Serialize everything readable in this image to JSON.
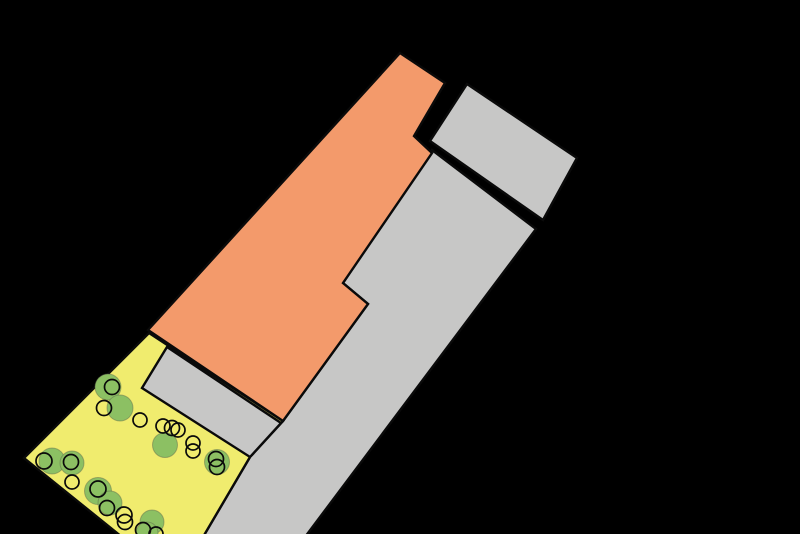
{
  "canvas": {
    "width": 800,
    "height": 534,
    "background": "#000000"
  },
  "palette": {
    "building_orange": "#F39A6B",
    "surface_gray": "#C7C7C6",
    "green_space_yellow": "#F0EC6E",
    "tree_green": "#8CC063",
    "outline_black": "#0A0A0A"
  },
  "site_plan": {
    "stroke_width_shapes": 2.4,
    "stroke_width_trees": 1.7,
    "shapes": [
      {
        "id": "road-parcel",
        "fill_key": "surface_gray",
        "points": [
          [
            432,
            150
          ],
          [
            536,
            229
          ],
          [
            305,
            537
          ],
          [
            203,
            537
          ],
          [
            250,
            457
          ],
          [
            283,
            421
          ],
          [
            368,
            304
          ],
          [
            343,
            283
          ]
        ]
      },
      {
        "id": "green-space",
        "fill_key": "green_space_yellow",
        "points": [
          [
            149,
            333
          ],
          [
            283,
            421
          ],
          [
            250,
            457
          ],
          [
            203,
            537
          ],
          [
            122,
            537
          ],
          [
            24,
            458
          ]
        ]
      },
      {
        "id": "parking-area",
        "fill_key": "surface_gray",
        "points": [
          [
            167,
            347
          ],
          [
            281,
            423
          ],
          [
            250,
            457
          ],
          [
            142,
            388
          ]
        ]
      },
      {
        "id": "main-building",
        "fill_key": "building_orange",
        "points": [
          [
            400,
            53
          ],
          [
            445,
            83
          ],
          [
            414,
            136
          ],
          [
            432,
            153
          ],
          [
            343,
            283
          ],
          [
            368,
            304
          ],
          [
            283,
            421
          ],
          [
            148,
            330
          ]
        ]
      },
      {
        "id": "annex-building",
        "fill_key": "surface_gray",
        "points": [
          [
            467,
            84
          ],
          [
            577,
            158
          ],
          [
            543,
            220
          ],
          [
            430,
            141
          ]
        ]
      }
    ],
    "trees_filled": [
      {
        "cx": 108,
        "cy": 387,
        "r": 13
      },
      {
        "cx": 120,
        "cy": 408,
        "r": 13
      },
      {
        "cx": 165,
        "cy": 445,
        "r": 12.5
      },
      {
        "cx": 217,
        "cy": 462,
        "r": 12.5
      },
      {
        "cx": 52,
        "cy": 461,
        "r": 13
      },
      {
        "cx": 72,
        "cy": 463,
        "r": 12
      },
      {
        "cx": 98,
        "cy": 491,
        "r": 13.5
      },
      {
        "cx": 110,
        "cy": 503,
        "r": 12
      },
      {
        "cx": 152,
        "cy": 522,
        "r": 12
      },
      {
        "cx": 147,
        "cy": 533,
        "r": 11
      }
    ],
    "trees_outlined": [
      {
        "cx": 112,
        "cy": 387,
        "r": 7.5
      },
      {
        "cx": 104,
        "cy": 408,
        "r": 7.5
      },
      {
        "cx": 140,
        "cy": 420,
        "r": 7
      },
      {
        "cx": 163,
        "cy": 426,
        "r": 7
      },
      {
        "cx": 172,
        "cy": 428,
        "r": 7.5
      },
      {
        "cx": 178,
        "cy": 430,
        "r": 7
      },
      {
        "cx": 193,
        "cy": 443,
        "r": 7
      },
      {
        "cx": 193,
        "cy": 451,
        "r": 7
      },
      {
        "cx": 216,
        "cy": 459,
        "r": 7.5
      },
      {
        "cx": 217,
        "cy": 467,
        "r": 7.5
      },
      {
        "cx": 44,
        "cy": 461,
        "r": 8
      },
      {
        "cx": 71,
        "cy": 462,
        "r": 7.5
      },
      {
        "cx": 72,
        "cy": 482,
        "r": 7
      },
      {
        "cx": 98,
        "cy": 489,
        "r": 8
      },
      {
        "cx": 107,
        "cy": 508,
        "r": 7.5
      },
      {
        "cx": 124,
        "cy": 515,
        "r": 8
      },
      {
        "cx": 125,
        "cy": 522,
        "r": 7.5
      },
      {
        "cx": 143,
        "cy": 530,
        "r": 7.5
      },
      {
        "cx": 156,
        "cy": 534,
        "r": 7
      }
    ]
  }
}
